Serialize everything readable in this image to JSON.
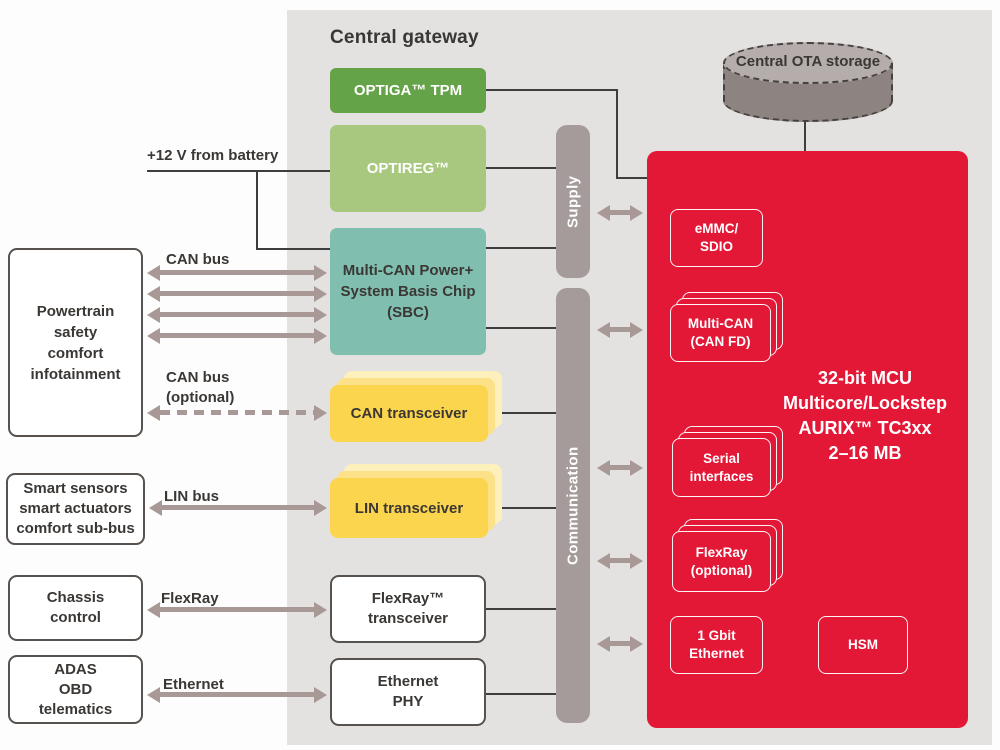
{
  "title": "Central gateway",
  "colors": {
    "panel_bg": "#e4e2e1",
    "mcu_red": "#e31837",
    "optiga_green": "#64a347",
    "optireg_green": "#a7c87e",
    "sbc_teal": "#80bfb0",
    "transceiver_yellow": "#fcd54e",
    "transceiver_yellow_light": "#fce188",
    "rail_gray": "#a49b9a",
    "arrow_mauve": "#a89896",
    "storage_gray": "#8d8482",
    "line_dark": "#3e3e3e",
    "text_dark": "#3a3734"
  },
  "labels": {
    "battery": "+12 V  from battery",
    "can_bus": "CAN bus",
    "can_bus_optional": "CAN bus\n(optional)",
    "lin_bus": "LIN bus",
    "flexray": "FlexRay",
    "ethernet": "Ethernet"
  },
  "left_nodes": [
    {
      "label": "Powertrain\nsafety\ncomfort\ninfotainment"
    },
    {
      "label": "Smart sensors\nsmart actuators\ncomfort sub-bus"
    },
    {
      "label": "Chassis\ncontrol"
    },
    {
      "label": "ADAS\nOBD\ntelematics"
    }
  ],
  "gateway": {
    "optiga": "OPTIGA™ TPM",
    "optireg": "OPTIREG™",
    "sbc": "Multi-CAN Power+\nSystem Basis Chip\n(SBC)",
    "can_transceiver": "CAN transceiver",
    "lin_transceiver": "LIN transceiver",
    "flexray_transceiver": "FlexRay™\ntransceiver",
    "ethernet_phy": "Ethernet\nPHY"
  },
  "rails": {
    "supply": "Supply",
    "communication": "Communication"
  },
  "storage": {
    "label": "Central OTA storage"
  },
  "mcu": {
    "title": "32-bit MCU\nMulticore/Lockstep\nAURIX™ TC3xx\n2–16 MB",
    "modules": {
      "emmc": "eMMC/\nSDIO",
      "multi_can": "Multi-CAN\n(CAN FD)",
      "serial": "Serial\ninterfaces",
      "flexray_optional": "FlexRay\n(optional)",
      "gbit_ethernet": "1 Gbit\nEthernet",
      "hsm": "HSM"
    }
  }
}
